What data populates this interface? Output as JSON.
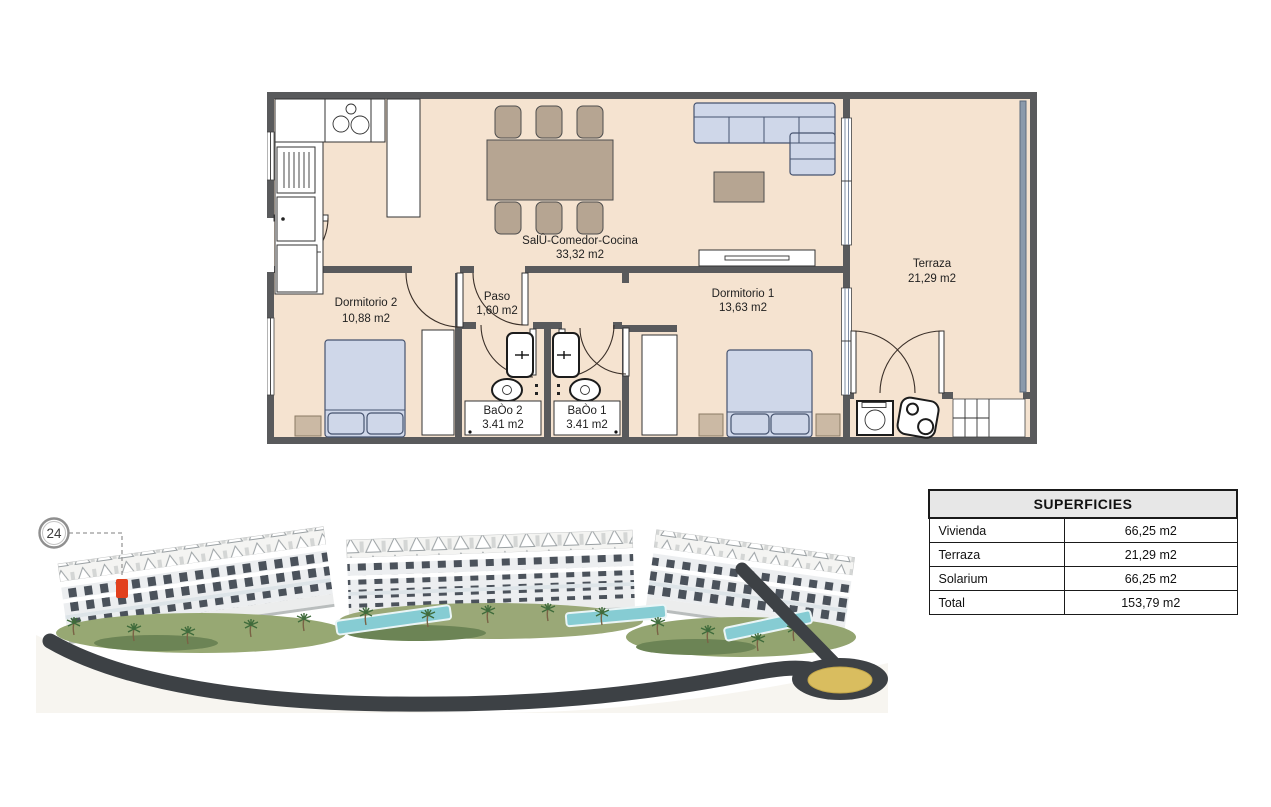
{
  "floor_plan": {
    "labels": {
      "salon": {
        "name": "SalÛ-Comedor-Cocina",
        "area": "33,32 m2"
      },
      "terraza": {
        "name": "Terraza",
        "area": "21,29 m2"
      },
      "dormitorio2": {
        "name": "Dormitorio 2",
        "area": "10,88 m2"
      },
      "paso": {
        "name": "Paso",
        "area": "1,60 m2"
      },
      "dormitorio1": {
        "name": "Dormitorio 1",
        "area": "13,63 m2"
      },
      "bano2": {
        "name": "BaÒo 2",
        "area": "3.41 m2"
      },
      "bano1": {
        "name": "BaÒo 1",
        "area": "3.41 m2"
      }
    },
    "colors": {
      "floor": "#f5e3d0",
      "wall": "#595a5c",
      "furniture_blue": "#cfd7e9",
      "furniture_tan": "#b6a592",
      "railing": "#8b9aab"
    }
  },
  "site_plan": {
    "unit_number": "24",
    "highlight_color": "#e2401d",
    "road_color": "#3d4145",
    "roundabout_color": "#d9bd5f",
    "pool_color": "#86ccd3",
    "green_color": "#97a873"
  },
  "superficies": {
    "title": "SUPERFICIES",
    "rows": [
      {
        "label": "Vivienda",
        "value": "66,25 m2"
      },
      {
        "label": "Terraza",
        "value": "21,29 m2"
      },
      {
        "label": "Solarium",
        "value": "66,25 m2"
      },
      {
        "label": "Total",
        "value": "153,79 m2"
      }
    ]
  }
}
